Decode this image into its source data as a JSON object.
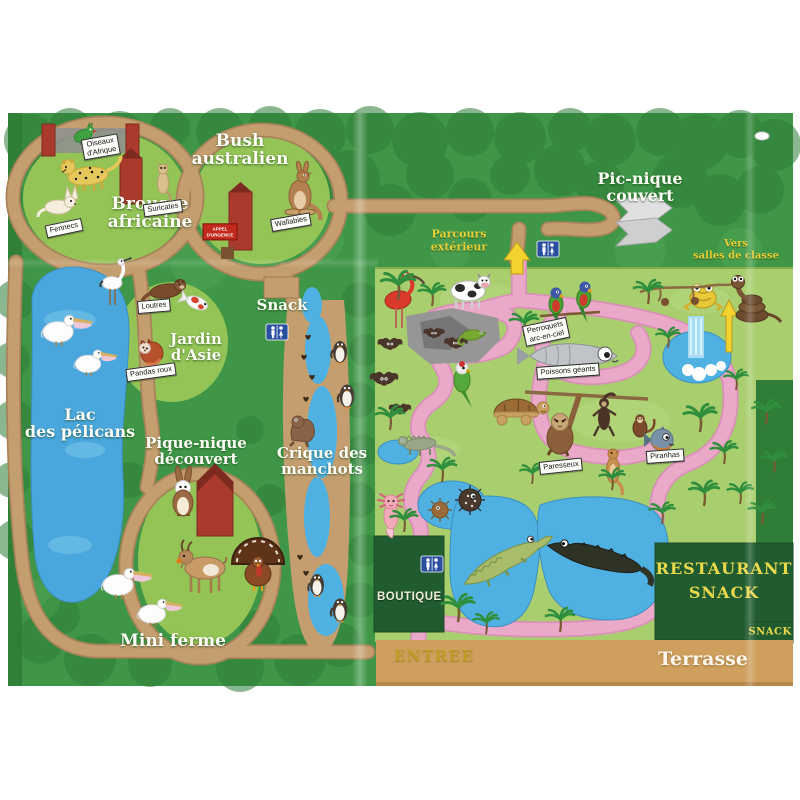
{
  "areas": [
    {
      "line1": "Brousse",
      "line2": "africaine"
    },
    {
      "line1": "Bush",
      "line2": "australien"
    },
    {
      "line1": "Pic-nique",
      "line2": "couvert"
    },
    {
      "line1": "Snack",
      "line2": ""
    },
    {
      "line1": "Lac",
      "line2": "des pélicans"
    },
    {
      "line1": "Jardin",
      "line2": "d'Asie"
    },
    {
      "line1": "Pique-nique",
      "line2": "découvert"
    },
    {
      "line1": "Crique des",
      "line2": "manchots"
    },
    {
      "line1": "Mini ferme",
      "line2": ""
    }
  ],
  "nav": {
    "parcours_line1": "Parcours",
    "parcours_line2": "extérieur",
    "vers_line1": "Vers",
    "vers_line2": "salles de classe"
  },
  "tags": [
    {
      "label": "Oiseaux",
      "label2": "d'Afrique"
    },
    {
      "label": "Fennecs"
    },
    {
      "label": "Suricates"
    },
    {
      "label": "Wallabies"
    },
    {
      "label": "Loutres"
    },
    {
      "label": "Pandas roux"
    },
    {
      "label": "Perroquets",
      "label2": "arc-en-ciel"
    },
    {
      "label": "Poissons géants"
    },
    {
      "label": "Paresseux"
    },
    {
      "label": "Piranhas"
    }
  ],
  "signs": {
    "appel_line1": "APPEL",
    "appel_line2": "D'URGENCE",
    "boutique": "BOUTIQUE",
    "restaurant_line1": "RESTAURANT",
    "restaurant_line2": "SNACK",
    "snack_corner": "SNACK",
    "entree": "ENTREE",
    "terrasse": "Terrasse"
  },
  "icons": {
    "toilets": "wc-pictogram white figures on blue",
    "direction_arrow": "yellow up arrow",
    "shelter": "grey covered picnic shelter",
    "barn": "red farm barn"
  },
  "colors": {
    "outdoor_green": "#3f9647",
    "canopy_green": "#2e7d36",
    "island_green": "#93c455",
    "indoor_green": "#a9ce6e",
    "path_tan": "#c49e6e",
    "path_pink": "#eba9c9",
    "water_blue": "#4aa7dd",
    "dark_green_box": "#215c30",
    "accent_yellow": "#ead84a",
    "barn_red": "#a93a2c",
    "terrasse_tan": "#cf9f5e"
  },
  "depicted_animals": [
    "turaco",
    "cheetah",
    "fennec",
    "suricate",
    "kangaroo-wallaby",
    "stork",
    "otter",
    "koi",
    "red-panda",
    "pelicans",
    "penguins",
    "sea-lion",
    "rabbit",
    "goat",
    "turkey",
    "scarlet-ibis",
    "cow",
    "bats",
    "chameleon",
    "green-parrot",
    "rainbow-parrots",
    "tortoise",
    "iguana",
    "giant-fish",
    "sloth",
    "spider-monkey",
    "capuchin",
    "piranha",
    "mongoose",
    "pufferfish",
    "axolotl",
    "crocodile",
    "alligator",
    "frog",
    "snake",
    "cockatoo"
  ]
}
